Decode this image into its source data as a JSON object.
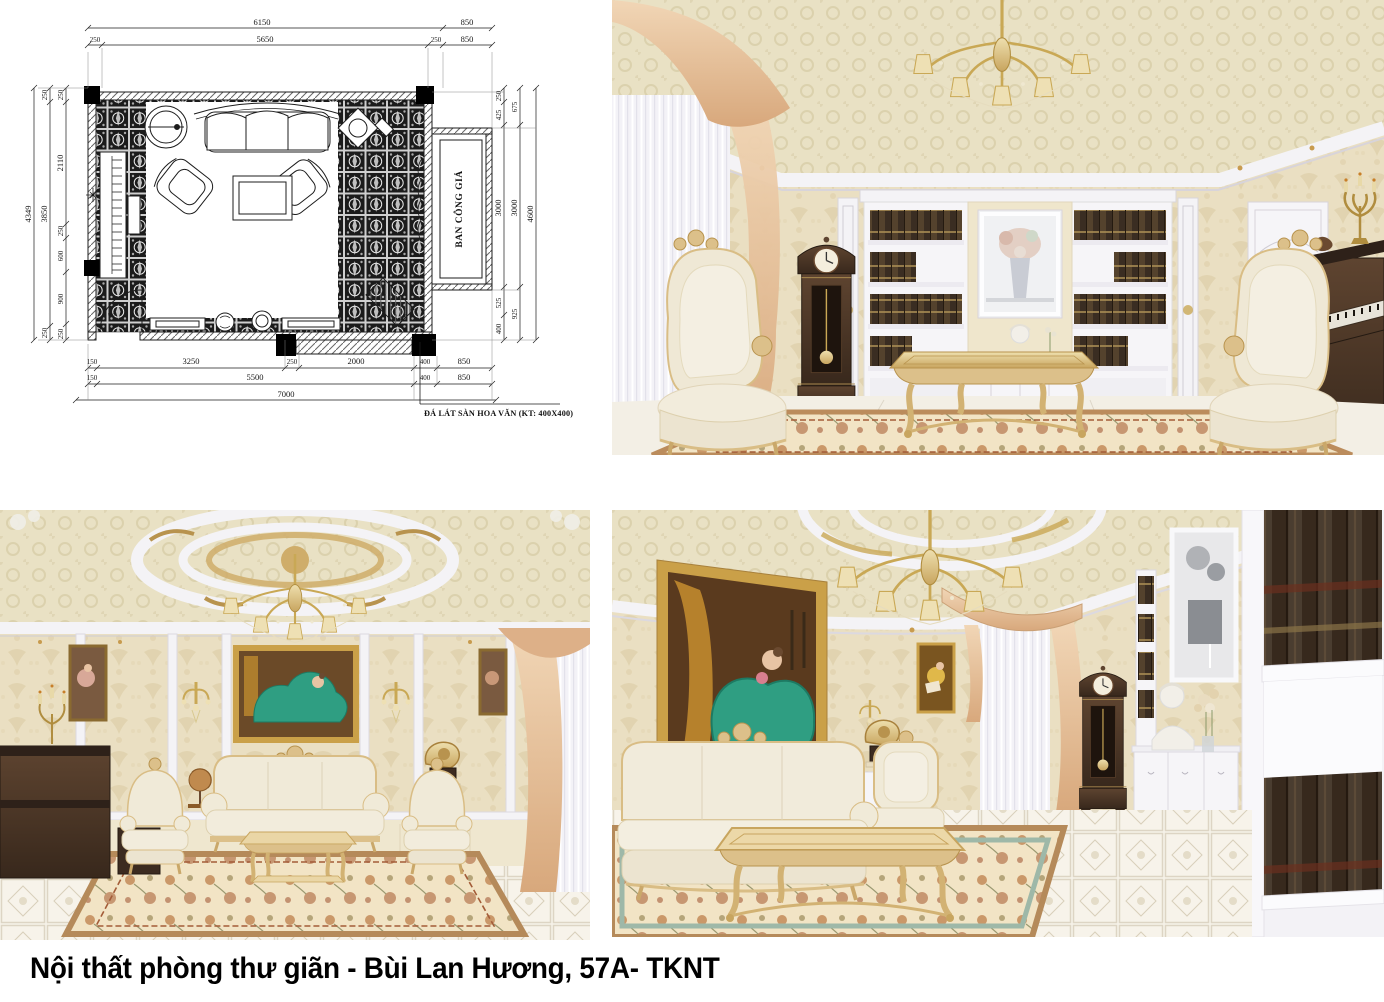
{
  "caption": "Nội thất phòng thư giãn - Bùi Lan Hương, 57A- TKNT",
  "floor_plan": {
    "balcony_label": "BAN CÔNG GIẢ",
    "floor_note": "ĐÁ LÁT SÀN HOA VĂN (KT: 400X400)",
    "door_width": "900",
    "dims_top_row1": [
      "6150",
      "850"
    ],
    "dims_top_row2": [
      "250",
      "5650",
      "250",
      "850"
    ],
    "dims_left_outer": "4349",
    "dims_left_mid": [
      "250",
      "3850",
      "250"
    ],
    "dims_left_inner": [
      "250",
      "2110",
      "250",
      "600",
      "900",
      "250"
    ],
    "dims_right_inner": [
      "250",
      "425",
      "3000",
      "525",
      "400"
    ],
    "dims_right_mid": [
      "675",
      "3000",
      "925"
    ],
    "dims_right_outer": "4600",
    "dims_bottom_row1": [
      "150",
      "3250",
      "250",
      "2000",
      "400",
      "850"
    ],
    "dims_bottom_row2": [
      "150",
      "5500",
      "400",
      "850"
    ],
    "dims_bottom_total": "7000"
  },
  "scenes": {
    "top_right": "relaxation-room-front-view-render",
    "bottom_left": "relaxation-room-wide-view-render",
    "bottom_right": "relaxation-room-side-view-render"
  },
  "colors": {
    "paper_white": "#ffffff",
    "caption_black": "#000000",
    "plan_line": "#1c1c1c",
    "wall_cream": "#eadfc2",
    "ceiling_cream": "#e9e1c4",
    "trim_white": "#f4f3f6",
    "curtain_peach": "#dfb68c",
    "sheer_white": "#f3f2f7",
    "wood_dark": "#463226",
    "gold": "#c9a855",
    "upholstery_cream": "#f0ead8",
    "rug_cream": "#f2e4c5",
    "rug_rust": "#b5764f",
    "floor_ivory": "#f7f3ea",
    "painting_green": "#2f9e82",
    "frame_gold": "#caa048",
    "book_brown": "#3a2d22"
  }
}
